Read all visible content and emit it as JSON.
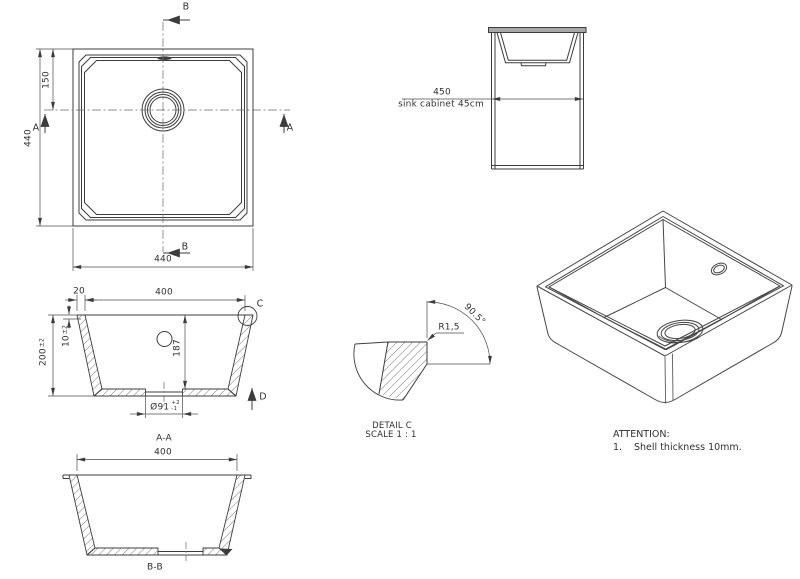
{
  "plan": {
    "label_b": "B",
    "label_a": "A",
    "dim_side": "440",
    "dim_drain_offset": "150",
    "dim_width": "440"
  },
  "cabinet": {
    "dim_width": "450",
    "caption": "sink cabinet 45cm"
  },
  "section_aa": {
    "dim_rim_width": "20",
    "dim_inner_width": "400",
    "dim_height": "200",
    "dim_height_tol": "±2",
    "dim_shell": "10",
    "dim_shell_tol": "±2",
    "dim_depth": "187",
    "dim_drain_dia": "Ø91",
    "dim_drain_tol_plus": "+2",
    "dim_drain_tol_minus": "-1",
    "balloon": "C",
    "direction": "D",
    "label": "A-A"
  },
  "section_bb": {
    "dim_inner_width": "400",
    "label": "B-B"
  },
  "detail_c": {
    "angle": "90.5°",
    "radius": "R1,5",
    "title": "DETAIL C",
    "scale": "SCALE 1 : 1"
  },
  "attention": {
    "title": "ATTENTION:",
    "item_no": "1.",
    "item_text": "Shell thickness 10mm."
  },
  "colors": {
    "line": "#3c3c3c",
    "dim_line": "#4d4d4d",
    "hatch": "#555555",
    "countertop_fill": "#a9a9a9",
    "text": "#303030",
    "background": "#ffffff"
  }
}
